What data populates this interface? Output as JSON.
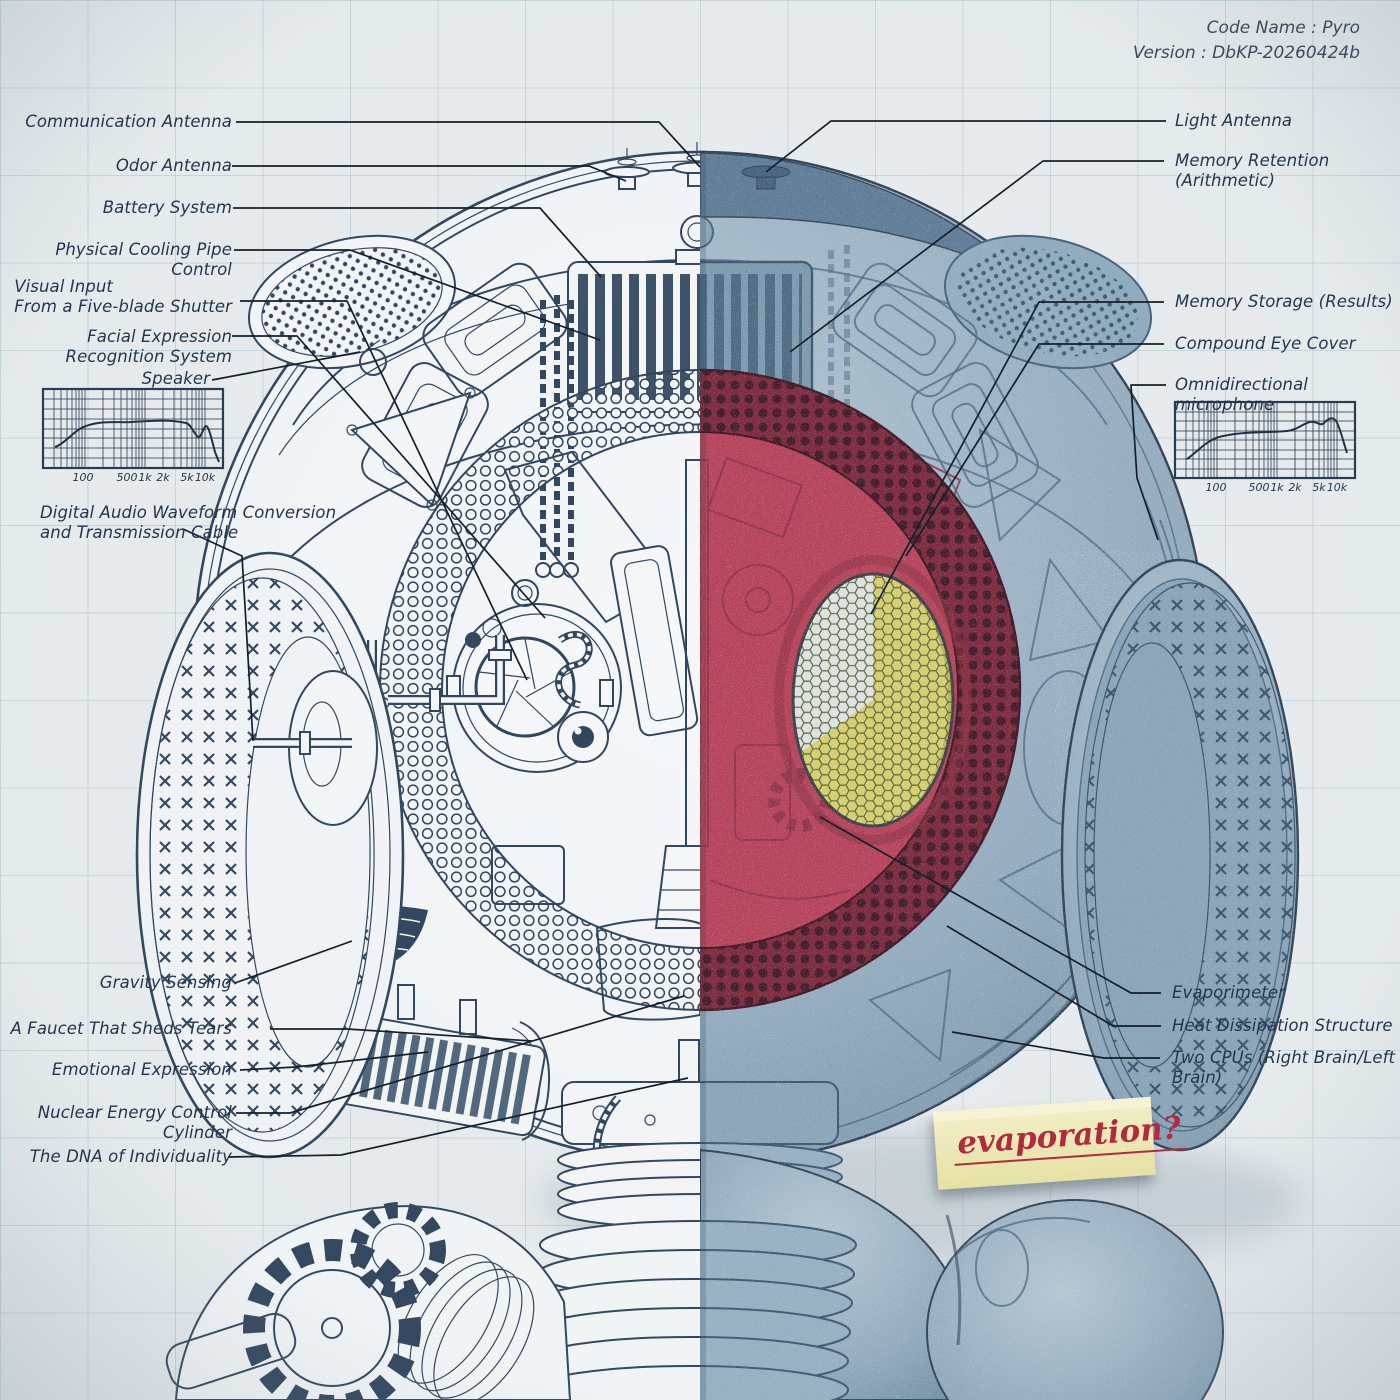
{
  "meta": {
    "code_name": "Code Name : Pyro",
    "version": "Version : DbKP-20260424b"
  },
  "labels": {
    "left": [
      "Communication Antenna",
      "Odor Antenna",
      "Battery System",
      "Physical Cooling Pipe Control",
      "Visual Input\nFrom a Five-blade Shutter",
      "Facial Expression Recognition System",
      "Speaker",
      "Digital Audio Waveform Conversion\nand Transmission Cable",
      "Gravity Sensing",
      "A Faucet That Sheds Tears",
      "Emotional Expression",
      "Nuclear Energy Control Cylinder",
      "The DNA of Individuality"
    ],
    "right": [
      "Light Antenna",
      "Memory Retention (Arithmetic)",
      "Memory Storage (Results)",
      "Compound Eye Cover",
      "Omnidirectional microphone",
      "Evaporimeter",
      "Heat Dissipation Structure",
      "Two CPUs (Right Brain/Left Brain)"
    ]
  },
  "graphs": {
    "freq_ticks": [
      "100",
      "500",
      "1k",
      "2k",
      "5k",
      "10k"
    ],
    "left_graph": "speaker-frequency-response",
    "right_graph": "microphone-frequency-response"
  },
  "note": {
    "text": "evaporation?"
  },
  "colors": {
    "ink": "#31465e",
    "shell_blue": "#92aabd",
    "face_plate_red": "#b5435a",
    "ring_dark_red": "#7b2a3d",
    "eye_yellow": "#d5cf6d",
    "note_yellow": "#efecc0",
    "note_text_red": "#b12a3e"
  }
}
